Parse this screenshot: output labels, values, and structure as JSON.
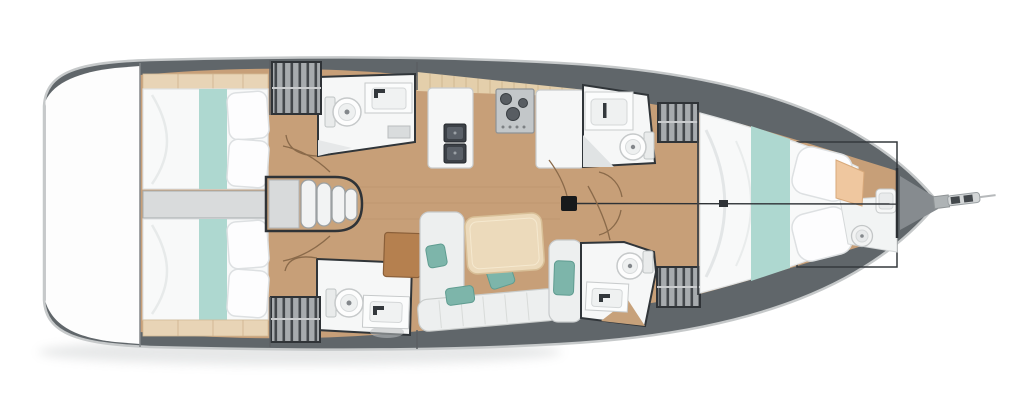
{
  "page": {
    "title": "Sailing yacht interior deck plan",
    "description": "Top-down floor plan of a sailing yacht: two aft cabins, four heads, galley, salon and forward owner cabin"
  },
  "colors": {
    "page_bg": "#ffffff",
    "hull_white": "#fdfdfd",
    "hull_edge": "#c6c9ca",
    "deck_band": "#60666a",
    "floor_wood": "#c79f78",
    "shelf_tan": "#e8d4b6",
    "backsplash_tan": "#e4cfab",
    "bed_linen": "#f8f9f9",
    "bed_runner_teal": "#aed8d0",
    "pillow_white": "#fdfdfe",
    "cushion_teal": "#7db5aa",
    "sofa_white": "#edefef",
    "table_beige": "#ecdabb",
    "chart_table_brown": "#b5804f",
    "fixture_white": "#f6f7f7",
    "sink_dark": "#3c4147",
    "stove_gray": "#c3c7c9",
    "locker_gray": "#a7abae",
    "engine_gray": "#d9dbdc",
    "outline_dark": "#303539",
    "mast_black": "#17191b",
    "door_arc_brown": "#8a6a4a",
    "cabinet_peach": "#efc79f",
    "step_white": "#f2f3f3",
    "shadow_gray": "#c9cccd"
  },
  "regions": {
    "swim_platform": "Swim platform / transom",
    "aft_cabin_port": "Aft double cabin (port)",
    "aft_cabin_starboard": "Aft double cabin (starboard)",
    "engine_compartment": "Engine compartment",
    "companionway": "Companionway steps",
    "aft_head_port": "Aft head with shower (port)",
    "aft_head_starboard": "Aft head with shower (starboard)",
    "wardrobe": "Hanging locker",
    "galley": "L-shaped galley",
    "sink_double": "Double galley sink",
    "stove": "Three-burner stove",
    "salon": "Salon settee",
    "salon_table": "Salon table",
    "chart_table": "Chart table",
    "fwd_head_port": "Forward head (port)",
    "fwd_head_starboard": "Forward head (starboard)",
    "mast": "Mast",
    "forestay": "Forestay",
    "fwd_cabin": "Forward owner cabin",
    "forepeak": "Forepeak washroom",
    "bow_fitting": "Bow roller / anchor fitting"
  }
}
